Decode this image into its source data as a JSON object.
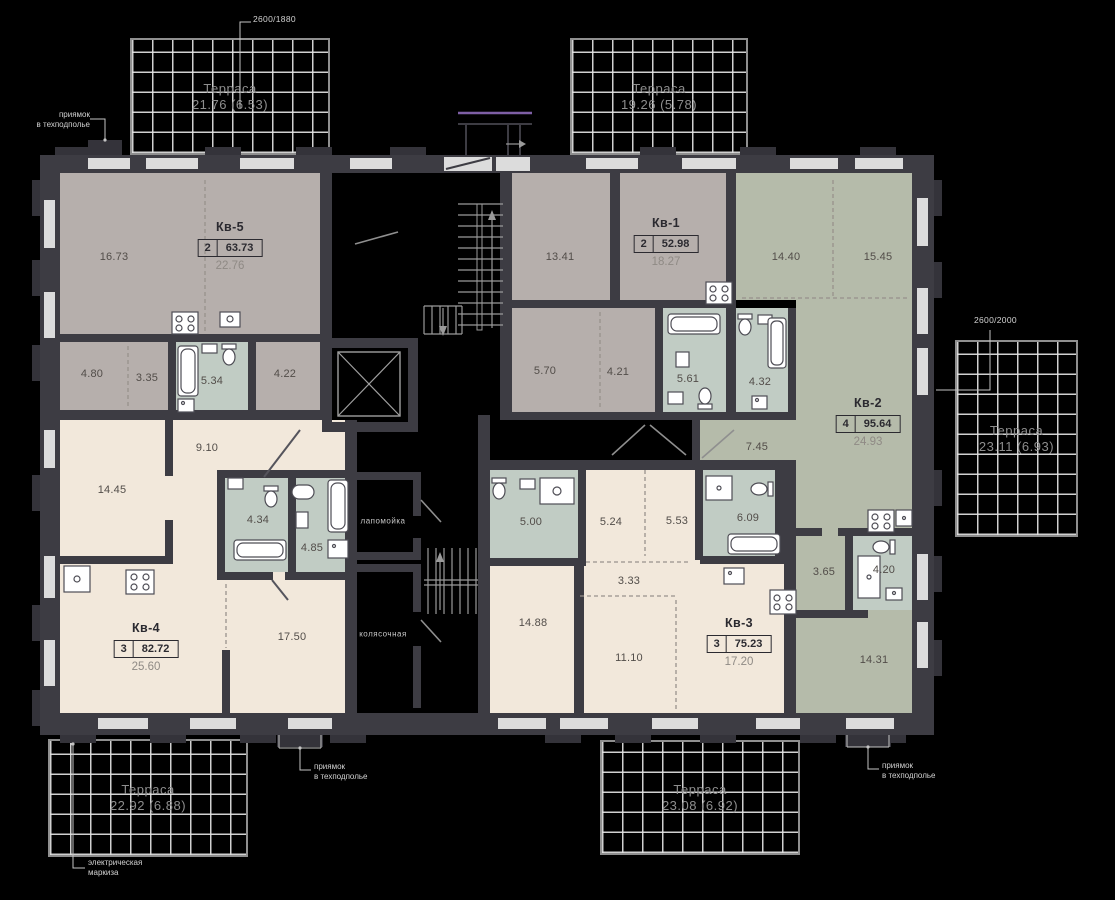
{
  "colors": {
    "bg": "#000000",
    "wall": "#3d3c43",
    "wall_dark": "#34333a",
    "floor_gray": "#b6afac",
    "floor_green": "#b5bbaa",
    "floor_cream": "#f2e8db",
    "floor_bath": "#c1ccc4",
    "window": "#dcdcdc",
    "room_text": "#524d49",
    "label_dark": "#2b2a30",
    "sub_text": "#8f8a85",
    "terrace_text": "#8d8d8d",
    "annotation": "#d2d2d2",
    "accent_purple": "#7e5fa5"
  },
  "apartments": [
    {
      "name": "Кв-5",
      "rooms_count": "2",
      "total_area": "63.73",
      "living_area": "22.76",
      "rooms": [
        "16.73",
        "4.80",
        "3.35",
        "5.34",
        "4.22"
      ]
    },
    {
      "name": "Кв-1",
      "rooms_count": "2",
      "total_area": "52.98",
      "living_area": "18.27",
      "rooms": [
        "13.41",
        "5.70",
        "4.21",
        "5.61",
        "4.32"
      ]
    },
    {
      "name": "Кв-2",
      "rooms_count": "4",
      "total_area": "95.64",
      "living_area": "24.93",
      "rooms": [
        "14.40",
        "15.45",
        "7.45",
        "3.65",
        "4.20",
        "14.31"
      ]
    },
    {
      "name": "Кв-3",
      "rooms_count": "3",
      "total_area": "75.23",
      "living_area": "17.20",
      "rooms": [
        "5.00",
        "5.24",
        "5.53",
        "6.09",
        "3.33",
        "14.88",
        "11.10"
      ]
    },
    {
      "name": "Кв-4",
      "rooms_count": "3",
      "total_area": "82.72",
      "living_area": "25.60",
      "rooms": [
        "9.10",
        "14.45",
        "4.34",
        "4.85",
        "17.50"
      ]
    }
  ],
  "terraces": [
    {
      "label": "Терраса",
      "area": "21.76 (6.53)"
    },
    {
      "label": "Терраса",
      "area": "19.26 (5.78)"
    },
    {
      "label": "Терраса",
      "area": "23.11 (6.93)"
    },
    {
      "label": "Терраса",
      "area": "22.92 (6.88)"
    },
    {
      "label": "Терраса",
      "area": "23.08 (6.92)"
    }
  ],
  "common_areas": {
    "paw_wash": "лапомойка",
    "stroller_room": "колясочная"
  },
  "annotations": {
    "pit": "приямок\nв техподполье",
    "awning": "электрическая\nмаркиза",
    "dim_top": "2600/1880",
    "dim_right": "2600/2000"
  }
}
